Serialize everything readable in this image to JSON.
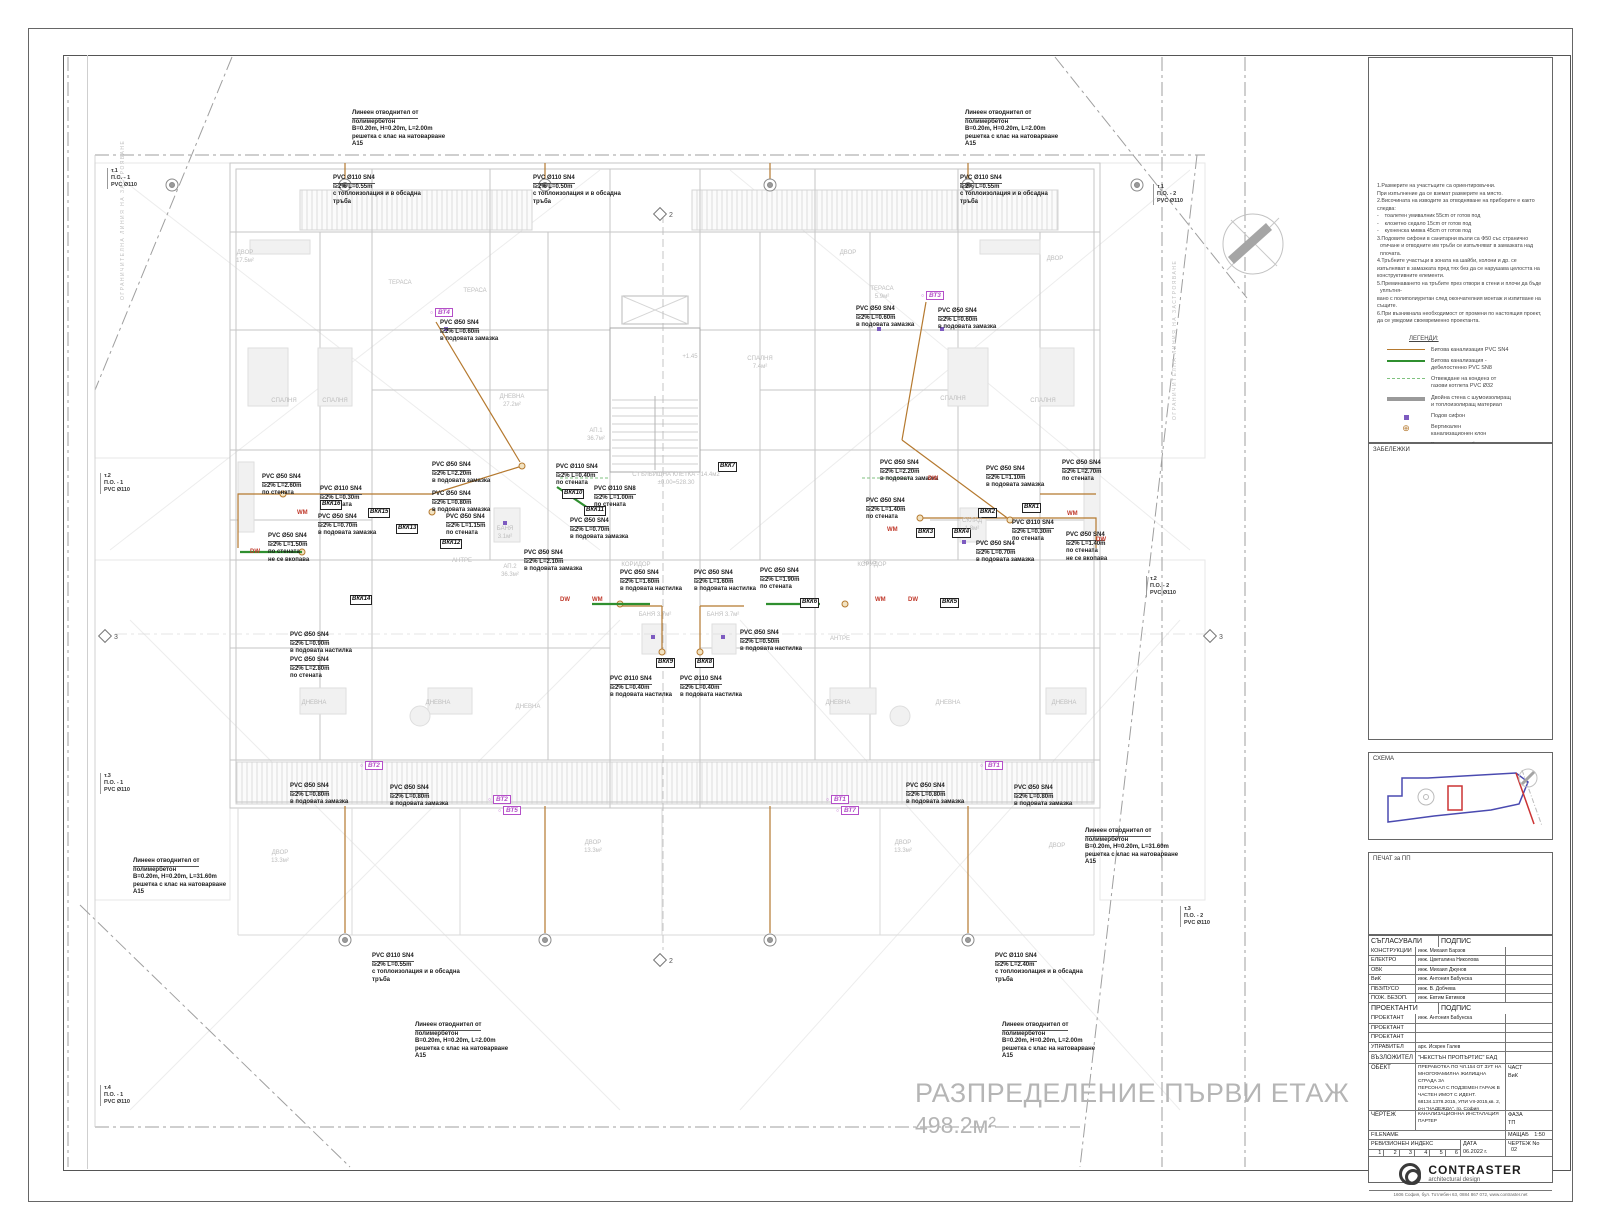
{
  "sheet": {
    "plan_title": "РАЗПРЕДЕЛЕНИЕ ПЪРВИ ЕТАЖ",
    "plan_area": "498.2м²"
  },
  "colors": {
    "pipe_sn4": "#b5792f",
    "pipe_sn8": "#2f8f2f",
    "condensate": "#7fc27f",
    "vt_label": "#b44fc8",
    "appliance": "#c0392b",
    "siphon": "#7d5bc0",
    "wall": "#c6c6c6"
  },
  "notes": {
    "lines": [
      "1.Размерите на участъците са ориентировъчни.",
      "При изпълнение да се вземат размерите на място.",
      "2.Височината на изводите за отводняване на приборите е както",
      "следва:",
      "-    тоалетен умивалник 55cm от готов под",
      "-    клозетно седало 15cm от готов под",
      "-    кухненска мивка 45cm от готов под",
      "3.Подовите сифони в санитарни възли са Ф50 със странично",
      "  отичане и отводните им тръби се изпълняват в замазката над",
      "  плочата.",
      "4.Тръбните участъци в зоната на шайби, колони и др. се",
      "изпълняват в замазката пред тях без да се нарушава целостта на",
      "конструктивните елементи.",
      "5.Преминаването на тръбите през отвори в стени и плочи да бъде",
      "  уплътня-",
      "вано с полиполиуретан след окончателния монтаж и изпитване на",
      "същите.",
      "6.При възникнала необходимост от промени по настоящия проект,",
      "да се уведоми своевременно проектанта."
    ]
  },
  "legend": {
    "title": "ЛЕГЕНДИ:",
    "items": [
      {
        "key": "sn4",
        "lines": "Битова канализация PVC SN4"
      },
      {
        "key": "sn8",
        "lines": "Битова канализация -\nдебелостенно PVC SN8"
      },
      {
        "key": "cond",
        "lines": "Отвеждане на конденз от\nгазови котлета PVC Ø32"
      },
      {
        "key": "wall",
        "lines": "Двойна стена с шумоизолиращ\nи топлоизолиращ материал"
      },
      {
        "key": "siphon",
        "lines": "Подов сифон"
      },
      {
        "key": "branch",
        "lines": "Вертикален\nканализационен клон"
      },
      {
        "key": "vt",
        "tag": "ВТ..",
        "lines": "Водосточна тръба"
      }
    ]
  },
  "boxes": {
    "zabelezhki": "ЗАБЕЛЕЖКИ",
    "schema": "СХЕМА",
    "pechat": "ПЕЧАТ за ПП"
  },
  "titleblock": {
    "approvals_header": "СЪГЛАСУВАЛИ ПРОЕКТАНТИ",
    "signature_header": "ПОДПИС",
    "approvals": [
      {
        "role": "КОНСТРУКЦИИ",
        "name": "инж. Михаил Барзов"
      },
      {
        "role": "ЕЛЕКТРО",
        "name": "инж. Цветалина Николова"
      },
      {
        "role": "ОВК",
        "name": "инж. Михаил Джунов"
      },
      {
        "role": "ВиК",
        "name": "инж. Антония Бабунска"
      },
      {
        "role": "ПБЗ/ПУСО",
        "name": "инж. В. Добчева"
      },
      {
        "role": "ПОЖ. БЕЗОП.",
        "name": "инж. Евтим Евтимов"
      }
    ],
    "designers_header": "ПРОЕКТАНТИ",
    "designers": [
      {
        "role": "ПРОЕКТАНТ",
        "name": "инж. Антония Бабунска"
      },
      {
        "role": "ПРОЕКТАНТ",
        "name": ""
      },
      {
        "role": "ПРОЕКТАНТ",
        "name": ""
      },
      {
        "role": "УПРАВИТЕЛ",
        "name": "арх. Искрен Галев"
      }
    ],
    "client_label": "ВЪЗЛОЖИТЕЛ",
    "client_value": "\"НЕКСТЪН ПРОПЪРТИС\" ЕАД",
    "object_label": "ОБЕКТ",
    "object_lines": [
      "ПРЕРАБОТКА ПО ЧЛ.154 ОТ ЗУТ НА",
      "МНОГОФАМИЛНА ЖИЛИЩНА СГРАДА ЗА",
      "ПЕРСОНАЛ С ПОДЗЕМЕН ГАРАЖ В",
      "ЧАСТЕН ИМОТ С ИДЕНТ.",
      "68134.1378.2015, УПИ VII-2015,кв. 2,",
      "р-н \"НАДЕЖДА\", гр. София"
    ],
    "part_label": "ЧАСТ",
    "part_value": "ВиК",
    "drawing_label": "ЧЕРТЕЖ",
    "drawing_lines": [
      "КАНАЛИЗАЦИОННА ИНСТАЛАЦИЯ",
      "ПАРТЕР"
    ],
    "phase_label": "ФАЗА",
    "phase_value": "ТП",
    "filename_label": "FILENAME",
    "scale_label": "МАЩАБ",
    "scale_value": "1:50",
    "revision_label": "РЕВИЗИОНЕН ИНДЕКС",
    "revision_cells": [
      "1",
      "2",
      "3",
      "4",
      "5",
      "6"
    ],
    "date_label": "ДАТА",
    "date_value": "06.2022 г.",
    "number_label": "ЧЕРТЕЖ No",
    "number_value": "02",
    "logo_name": "CONTRASTER",
    "logo_sub": "architectural design",
    "address": "1606 София, бул. Тотлебен 63, 0884 867 072, www.contraster.net"
  },
  "plan": {
    "pipe_annotations": [
      {
        "x": 352,
        "y": 110,
        "lines": [
          "Линеен отводнител от",
          "полимербетон",
          "B=0.20m, H=0.20m, L=2.00m",
          "решетка с клас на натоварване",
          "A15"
        ]
      },
      {
        "x": 965,
        "y": 110,
        "lines": [
          "Линеен отводнител от",
          "полимербетон",
          "B=0.20m, H=0.20m, L=2.00m",
          "решетка с клас на натоварване",
          "A15"
        ]
      },
      {
        "x": 333,
        "y": 175,
        "lines": [
          "PVC Ø110 SN4",
          "i≥2% L=0.55m",
          "с топлоизолация и в обсадна",
          "тръба"
        ]
      },
      {
        "x": 533,
        "y": 175,
        "lines": [
          "PVC Ø110 SN4",
          "i≥2% L=0.50m",
          "с топлоизолация и в обсадна",
          "тръба"
        ]
      },
      {
        "x": 960,
        "y": 175,
        "lines": [
          "PVC Ø110 SN4",
          "i≥2% L=0.55m",
          "с топлоизолация и в обсадна",
          "тръба"
        ]
      },
      {
        "x": 440,
        "y": 320,
        "lines": [
          "PVC Ø50 SN4",
          "i≥2% L=0.60m",
          "в подовата замазка"
        ]
      },
      {
        "x": 856,
        "y": 306,
        "lines": [
          "PVC Ø50 SN4",
          "i≥2% L=0.60m",
          "в подовата замазка"
        ]
      },
      {
        "x": 938,
        "y": 308,
        "lines": [
          "PVC Ø50 SN4",
          "i≥2% L=0.60m",
          "в подовата замазка"
        ]
      },
      {
        "x": 262,
        "y": 474,
        "lines": [
          "PVC Ø50 SN4",
          "i≥2% L=2.60m",
          "по стената"
        ]
      },
      {
        "x": 320,
        "y": 486,
        "lines": [
          "PVC Ø110 SN4",
          "i≥2% L=0.30m",
          "по стената"
        ]
      },
      {
        "x": 318,
        "y": 514,
        "lines": [
          "PVC Ø50 SN4",
          "i≥2% L=0.70m",
          "в подовата замазка"
        ]
      },
      {
        "x": 268,
        "y": 533,
        "lines": [
          "PVC Ø50 SN4",
          "i≥2% L=1.50m",
          "по стената",
          "не се вкопава"
        ]
      },
      {
        "x": 432,
        "y": 462,
        "lines": [
          "PVC Ø50 SN4",
          "i≥2% L=2.20m",
          "в подовата замазка"
        ]
      },
      {
        "x": 432,
        "y": 491,
        "lines": [
          "PVC Ø50 SN4",
          "i≥2% L=0.80m",
          "в подовата замазка"
        ]
      },
      {
        "x": 446,
        "y": 514,
        "lines": [
          "PVC Ø50 SN4",
          "i≥2% L=1.15m",
          "по стената"
        ]
      },
      {
        "x": 556,
        "y": 464,
        "lines": [
          "PVC Ø110 SN4",
          "i≥2% L=0.40m",
          "по стената"
        ]
      },
      {
        "x": 594,
        "y": 486,
        "lines": [
          "PVC Ø110 SN8",
          "i≥2% L=1.00m",
          "по стената"
        ]
      },
      {
        "x": 570,
        "y": 518,
        "lines": [
          "PVC Ø50 SN4",
          "i≥2% L=0.70m",
          "в подовата замазка"
        ]
      },
      {
        "x": 524,
        "y": 550,
        "lines": [
          "PVC Ø50 SN4",
          "i≥2% L=2.10m",
          "в подовата замазка"
        ]
      },
      {
        "x": 620,
        "y": 570,
        "lines": [
          "PVC Ø50 SN4",
          "i≥2% L=1.60m",
          "в подовата настилка"
        ]
      },
      {
        "x": 694,
        "y": 570,
        "lines": [
          "PVC Ø50 SN4",
          "i≥2% L=1.60m",
          "в подовата настилка"
        ]
      },
      {
        "x": 760,
        "y": 568,
        "lines": [
          "PVC Ø50 SN4",
          "i≥2% L=1.90m",
          "по стената"
        ]
      },
      {
        "x": 740,
        "y": 630,
        "lines": [
          "PVC Ø50 SN4",
          "i≥2% L=0.50m",
          "в подовата настилка"
        ]
      },
      {
        "x": 610,
        "y": 676,
        "lines": [
          "PVC Ø110 SN4",
          "i≥2% L=0.40m",
          "в подовата настилка"
        ]
      },
      {
        "x": 680,
        "y": 676,
        "lines": [
          "PVC Ø110 SN4",
          "i≥2% L=0.40m",
          "в подовата настилка"
        ]
      },
      {
        "x": 290,
        "y": 632,
        "lines": [
          "PVC Ø50 SN4",
          "i≥2% L=0.90m",
          "в подовата настилка"
        ]
      },
      {
        "x": 290,
        "y": 657,
        "lines": [
          "PVC Ø50 SN4",
          "i≥2% L=2.80m",
          "по стената"
        ]
      },
      {
        "x": 880,
        "y": 460,
        "lines": [
          "PVC Ø50 SN4",
          "i≥2% L=2.20m",
          "в подовата замазка"
        ]
      },
      {
        "x": 986,
        "y": 466,
        "lines": [
          "PVC Ø50 SN4",
          "i≥2% L=1.10m",
          "в подовата замазка"
        ]
      },
      {
        "x": 1062,
        "y": 460,
        "lines": [
          "PVC Ø50 SN4",
          "i≥2% L=2.70m",
          "по стената"
        ]
      },
      {
        "x": 866,
        "y": 498,
        "lines": [
          "PVC Ø50 SN4",
          "i≥2% L=1.40m",
          "по стената"
        ]
      },
      {
        "x": 1012,
        "y": 520,
        "lines": [
          "PVC Ø110 SN4",
          "i≥2% L=0.30m",
          "по стената"
        ]
      },
      {
        "x": 976,
        "y": 541,
        "lines": [
          "PVC Ø50 SN4",
          "i≥2% L=0.70m",
          "в подовата замазка"
        ]
      },
      {
        "x": 1066,
        "y": 532,
        "lines": [
          "PVC Ø50 SN4",
          "i≥2% L=1.40m",
          "по стената",
          "не се вкопава"
        ]
      },
      {
        "x": 290,
        "y": 783,
        "lines": [
          "PVC Ø50 SN4",
          "i≥2% L=0.80m",
          "в подовата замазка"
        ]
      },
      {
        "x": 390,
        "y": 785,
        "lines": [
          "PVC Ø50 SN4",
          "i≥2% L=0.80m",
          "в подовата замазка"
        ]
      },
      {
        "x": 906,
        "y": 783,
        "lines": [
          "PVC Ø50 SN4",
          "i≥2% L=0.80m",
          "в подовата замазка"
        ]
      },
      {
        "x": 1014,
        "y": 785,
        "lines": [
          "PVC Ø50 SN4",
          "i≥2% L=0.80m",
          "в подовата замазка"
        ]
      },
      {
        "x": 133,
        "y": 858,
        "lines": [
          "Линеен отводнител от",
          "полимербетон",
          "B=0.20m, H=0.20m, L=31.60m",
          "решетка с клас на натоварване",
          "A15"
        ]
      },
      {
        "x": 1085,
        "y": 828,
        "lines": [
          "Линеен отводнител от",
          "полимербетон",
          "B=0.20m, H=0.20m, L=31.60m",
          "решетка с клас на натоварване",
          "A15"
        ]
      },
      {
        "x": 372,
        "y": 953,
        "lines": [
          "PVC Ø110 SN4",
          "i≥2% L=0.55m",
          "с топлоизолация и в обсадна",
          "тръба"
        ]
      },
      {
        "x": 995,
        "y": 953,
        "lines": [
          "PVC Ø110 SN4",
          "i≥2% L=2.40m",
          "с топлоизолация и в обсадна",
          "тръба"
        ]
      },
      {
        "x": 415,
        "y": 1022,
        "lines": [
          "Линеен отводнител от",
          "полимербетон",
          "B=0.20m, H=0.20m, L=2.00m",
          "решетка с клас на натоварване",
          "A15"
        ]
      },
      {
        "x": 1002,
        "y": 1022,
        "lines": [
          "Линеен отводнител от",
          "полимербетон",
          "B=0.20m, H=0.20m, L=2.00m",
          "решетка с клас на натоварване",
          "A15"
        ]
      }
    ],
    "vt_labels": [
      {
        "x": 430,
        "y": 309,
        "t": "ВТ4"
      },
      {
        "x": 921,
        "y": 292,
        "t": "ВТ3"
      },
      {
        "x": 360,
        "y": 762,
        "t": "ВТ2"
      },
      {
        "x": 980,
        "y": 762,
        "t": "ВТ1"
      },
      {
        "x": 488,
        "y": 796,
        "t": "ВТ2"
      },
      {
        "x": 498,
        "y": 807,
        "t": "ВТ5"
      },
      {
        "x": 826,
        "y": 796,
        "t": "ВТ1"
      },
      {
        "x": 836,
        "y": 807,
        "t": "ВТ7"
      }
    ],
    "vkk_labels": [
      {
        "x": 1022,
        "y": 503,
        "t": "ВКК1"
      },
      {
        "x": 978,
        "y": 508,
        "t": "ВКК2"
      },
      {
        "x": 916,
        "y": 528,
        "t": "ВКК3"
      },
      {
        "x": 952,
        "y": 528,
        "t": "ВКК4"
      },
      {
        "x": 940,
        "y": 598,
        "t": "ВКК5"
      },
      {
        "x": 800,
        "y": 598,
        "t": "ВКК6"
      },
      {
        "x": 718,
        "y": 462,
        "t": "ВКК7"
      },
      {
        "x": 695,
        "y": 658,
        "t": "ВКК8"
      },
      {
        "x": 656,
        "y": 658,
        "t": "ВКК9"
      },
      {
        "x": 562,
        "y": 489,
        "t": "ВКК10"
      },
      {
        "x": 584,
        "y": 506,
        "t": "ВКК11"
      },
      {
        "x": 440,
        "y": 539,
        "t": "ВКК12"
      },
      {
        "x": 396,
        "y": 524,
        "t": "ВКК13"
      },
      {
        "x": 350,
        "y": 595,
        "t": "ВКК14"
      },
      {
        "x": 368,
        "y": 508,
        "t": "ВКК15"
      },
      {
        "x": 320,
        "y": 500,
        "t": "ВКК16"
      }
    ],
    "appliances": [
      {
        "x": 297,
        "y": 510,
        "t": "WM"
      },
      {
        "x": 250,
        "y": 549,
        "t": "DW"
      },
      {
        "x": 560,
        "y": 597,
        "t": "DW"
      },
      {
        "x": 592,
        "y": 597,
        "t": "WM"
      },
      {
        "x": 875,
        "y": 597,
        "t": "WM"
      },
      {
        "x": 908,
        "y": 597,
        "t": "DW"
      },
      {
        "x": 928,
        "y": 476,
        "t": "DW"
      },
      {
        "x": 887,
        "y": 527,
        "t": "WM"
      },
      {
        "x": 1067,
        "y": 511,
        "t": "WM"
      },
      {
        "x": 1096,
        "y": 537,
        "t": "DW"
      }
    ],
    "rooms": [
      {
        "x": 245,
        "y": 250,
        "t": "ДВОР\n17.5м²"
      },
      {
        "x": 400,
        "y": 280,
        "t": "ТЕРАСА"
      },
      {
        "x": 475,
        "y": 288,
        "t": "ТЕРАСА"
      },
      {
        "x": 848,
        "y": 250,
        "t": "ДВОР"
      },
      {
        "x": 1055,
        "y": 256,
        "t": "ДВОР"
      },
      {
        "x": 882,
        "y": 286,
        "t": "ТЕРАСА\n5.9м²"
      },
      {
        "x": 284,
        "y": 398,
        "t": "СПАЛНЯ"
      },
      {
        "x": 335,
        "y": 398,
        "t": "СПАЛНЯ"
      },
      {
        "x": 512,
        "y": 394,
        "t": "ДНЕВНА\n27.2м²"
      },
      {
        "x": 760,
        "y": 356,
        "t": "СПАЛНЯ\n7.4м²"
      },
      {
        "x": 953,
        "y": 396,
        "t": "СПАЛНЯ"
      },
      {
        "x": 1043,
        "y": 398,
        "t": "СПАЛНЯ"
      },
      {
        "x": 676,
        "y": 472,
        "t": "СТЪЛБИЩНА КЛЕТКА - 14.4м2\n±0.00=528.30"
      },
      {
        "x": 690,
        "y": 354,
        "t": "+1.45"
      },
      {
        "x": 596,
        "y": 428,
        "t": "АП.1\n36.7м²"
      },
      {
        "x": 510,
        "y": 564,
        "t": "АП.2\n36.3м²"
      },
      {
        "x": 870,
        "y": 560,
        "t": "АП.5"
      },
      {
        "x": 505,
        "y": 526,
        "t": "БАНЯ\n3.1м²"
      },
      {
        "x": 655,
        "y": 612,
        "t": "БАНЯ 3.7м²"
      },
      {
        "x": 723,
        "y": 612,
        "t": "БАНЯ 3.7м²"
      },
      {
        "x": 972,
        "y": 518,
        "t": "СКЛАД\n1.8м²"
      },
      {
        "x": 636,
        "y": 562,
        "t": "КОРИДОР"
      },
      {
        "x": 872,
        "y": 562,
        "t": "КОРИДОР"
      },
      {
        "x": 462,
        "y": 558,
        "t": "АНТРЕ"
      },
      {
        "x": 840,
        "y": 636,
        "t": "АНТРЕ"
      },
      {
        "x": 314,
        "y": 700,
        "t": "ДНЕВНА"
      },
      {
        "x": 438,
        "y": 700,
        "t": "ДНЕВНА"
      },
      {
        "x": 528,
        "y": 704,
        "t": "ДНЕВНА"
      },
      {
        "x": 838,
        "y": 700,
        "t": "ДНЕВНА"
      },
      {
        "x": 948,
        "y": 700,
        "t": "ДНЕВНА"
      },
      {
        "x": 1064,
        "y": 700,
        "t": "ДНЕВНА"
      },
      {
        "x": 280,
        "y": 850,
        "t": "ДВОР\n13.3м²"
      },
      {
        "x": 593,
        "y": 840,
        "t": "ДВОР\n13.3м²"
      },
      {
        "x": 903,
        "y": 840,
        "t": "ДВОР\n13.3м²"
      },
      {
        "x": 1057,
        "y": 843,
        "t": "ДВОР"
      }
    ],
    "points": [
      {
        "x": 107,
        "y": 168,
        "lines": [
          "т.1",
          "П.О. - 1",
          "PVC Ø110"
        ]
      },
      {
        "x": 1153,
        "y": 184,
        "lines": [
          "т.1",
          "П.О. - 2",
          "PVC Ø110"
        ]
      },
      {
        "x": 100,
        "y": 473,
        "lines": [
          "т.2",
          "П.О. - 1",
          "PVC Ø110"
        ]
      },
      {
        "x": 1146,
        "y": 576,
        "lines": [
          "т.2",
          "П.О. - 2",
          "PVC Ø110"
        ]
      },
      {
        "x": 100,
        "y": 773,
        "lines": [
          "т.3",
          "П.О. - 1",
          "PVC Ø110"
        ]
      },
      {
        "x": 1180,
        "y": 906,
        "lines": [
          "т.3",
          "П.О. - 2",
          "PVC Ø110"
        ]
      },
      {
        "x": 100,
        "y": 1085,
        "lines": [
          "т.4",
          "П.О. - 1",
          "PVC Ø110"
        ]
      }
    ],
    "sections": [
      {
        "x": 100,
        "y": 628,
        "n": "3"
      },
      {
        "x": 1205,
        "y": 628,
        "n": "3"
      },
      {
        "x": 655,
        "y": 206,
        "n": "2"
      },
      {
        "x": 655,
        "y": 952,
        "n": "2"
      }
    ],
    "boundary_labels": [
      {
        "x": 120,
        "y": 300,
        "t": "ОГРАНИЧИТЕЛНА ЛИНИЯ НА ЗАСТРОЯВАНЕ"
      },
      {
        "x": 1172,
        "y": 420,
        "t": "ОГРАНИЧИТЕЛНА ЛИНИЯ НА ЗАСТРОЯВАНЕ"
      }
    ]
  }
}
